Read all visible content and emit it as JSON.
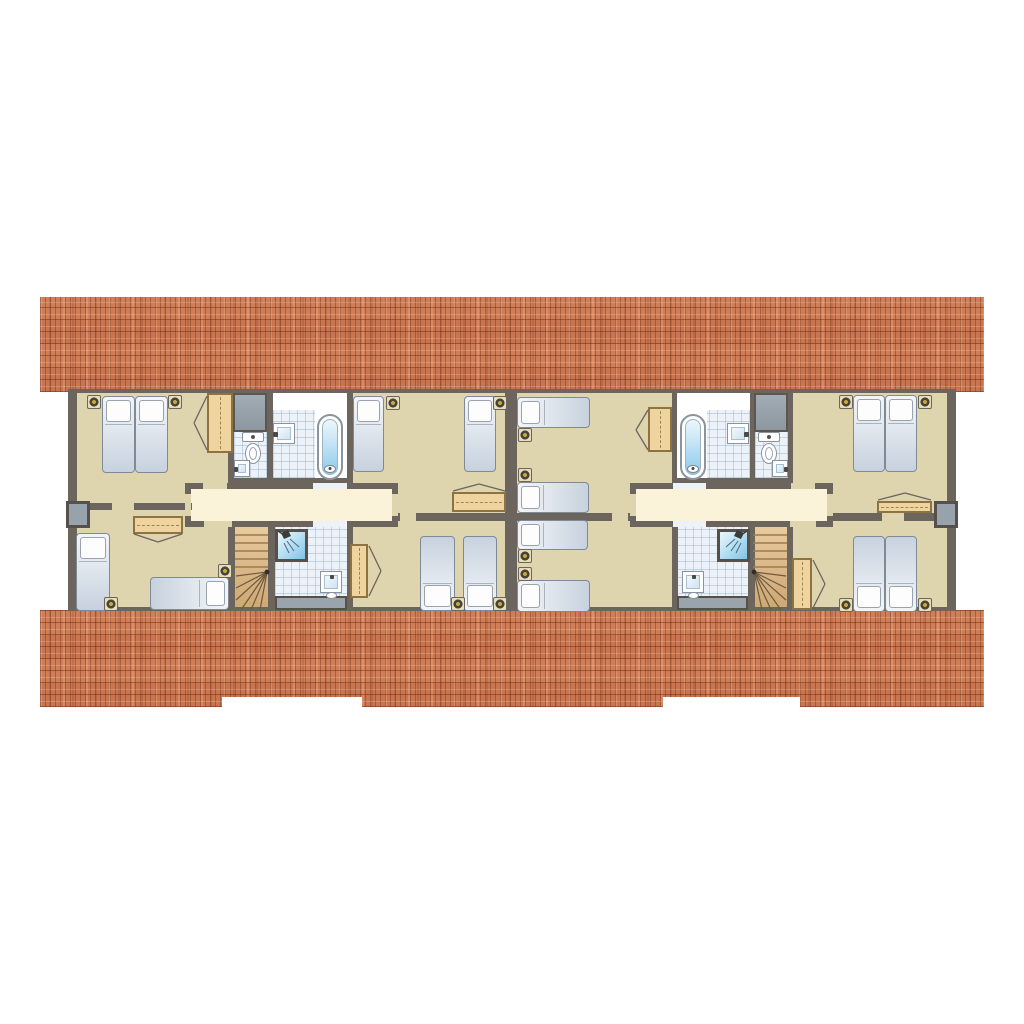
{
  "scene": {
    "description": "Top-down architectural floor plan of the upper (attic) floor of two adjoining semi-detached holiday homes, drawn between two terracotta tiled roof bands",
    "roof": {
      "top_band": "full-width tiled roof slope",
      "bottom_band": "full-width tiled roof slope with two rectangular eaves notches",
      "tile_color": "#cf7e58"
    },
    "colors": {
      "background": "#ffffff",
      "wall": "#6b655e",
      "room_floor": "#ded4ad",
      "landing_floor": "#faf3da",
      "tiled_floor": "#ecf2f8",
      "stair_wood": "#d8b383",
      "furniture_tan": "#efd49f",
      "fixture_white": "#ffffff",
      "water_blue": "#8ccaec",
      "cabinet_gray": "#98a2ab",
      "lamp_gold": "#c8a43b"
    }
  },
  "units": [
    {
      "name": "left unit",
      "rooms": [
        {
          "name": "bedroom top-left",
          "furniture": [
            "double bed of 2 single mattresses",
            "2 bedside lamps",
            "wardrobe with doors opening left"
          ]
        },
        {
          "name": "toilet room",
          "furniture": [
            "gray utility cabinet",
            "toilet",
            "small hand basin"
          ]
        },
        {
          "name": "bathroom",
          "furniture": [
            "wall washbasin",
            "bathtub"
          ]
        },
        {
          "name": "bedroom top-middle",
          "furniture": [
            "2 single beds",
            "2 bedside lamps",
            "low dresser with doors opening up"
          ]
        },
        {
          "name": "landing",
          "furniture": []
        },
        {
          "name": "bedroom bottom-left",
          "furniture": [
            "single bed vertical",
            "single bed horizontal",
            "2 bedside lamps",
            "dresser with doors opening down"
          ]
        },
        {
          "name": "staircase",
          "furniture": [
            "straight treads with winder fan at bottom"
          ]
        },
        {
          "name": "shower room",
          "furniture": [
            "shower cabin",
            "washbasin",
            "gray counter"
          ]
        },
        {
          "name": "bedroom bottom-middle",
          "furniture": [
            "2 single beds",
            "2 bedside lamps",
            "tall wardrobe with doors opening right"
          ]
        }
      ]
    },
    {
      "name": "right unit",
      "rooms": [
        {
          "name": "bedroom top-party-wall",
          "furniture": [
            "2 single beds stacked horizontally",
            "2 bedside lamps",
            "wardrobe with doors opening left"
          ]
        },
        {
          "name": "bathroom",
          "furniture": [
            "bathtub",
            "wall washbasin"
          ]
        },
        {
          "name": "toilet room",
          "furniture": [
            "gray utility cabinet",
            "toilet",
            "small hand basin"
          ]
        },
        {
          "name": "bedroom top-right",
          "furniture": [
            "double bed of 2 single mattresses",
            "2 bedside lamps",
            "low dresser with doors opening up"
          ]
        },
        {
          "name": "landing",
          "furniture": []
        },
        {
          "name": "bedroom bottom-party-wall",
          "furniture": [
            "2 single beds stacked horizontally",
            "2 bedside lamps"
          ]
        },
        {
          "name": "shower room",
          "furniture": [
            "shower cabin",
            "washbasin",
            "gray counter"
          ]
        },
        {
          "name": "staircase",
          "furniture": [
            "straight treads with winder fan at bottom"
          ]
        },
        {
          "name": "bedroom bottom-right",
          "furniture": [
            "double bed of 2 single mattresses",
            "2 bedside lamps",
            "tall wardrobe with doors opening right"
          ]
        }
      ]
    }
  ],
  "totals": {
    "single_bed_places": 16,
    "bathrooms": 2,
    "shower_rooms": 2,
    "toilet_rooms": 2,
    "staircases": 2
  }
}
